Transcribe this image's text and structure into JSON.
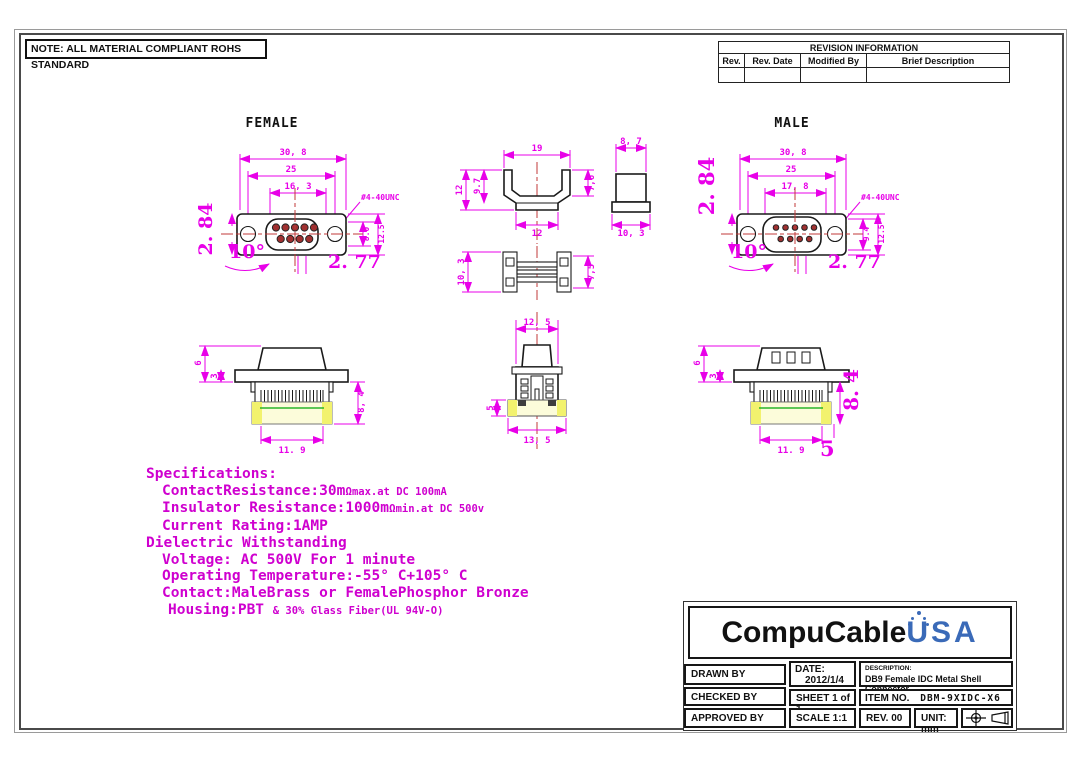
{
  "note": "NOTE: ALL MATERIAL COMPLIANT ROHS STANDARD",
  "colors": {
    "dimension_magenta": "#e800e8",
    "spec_magenta": "#cf00cf",
    "centerline_red": "#c03a3a",
    "highlight_yellow": "#f2f26e",
    "highlight_cyan": "#b7ecec",
    "logo_blue": "#3a6ab8"
  },
  "revision_table": {
    "title": "REVISION INFORMATION",
    "columns": [
      "Rev.",
      "Rev. Date",
      "Modified By",
      "Brief Description"
    ]
  },
  "views": {
    "female": {
      "label": "FEMALE",
      "front": {
        "width": "30, 8",
        "pitch": "25",
        "dsub": "16, 3",
        "screw": "#4-40UNC",
        "h1": "8.0",
        "h2": "12.5",
        "big_v": "2. 84",
        "angle": "10°",
        "big_h": "2. 77"
      },
      "side": {
        "d6": "6",
        "d3": "3",
        "d84": "8, 4",
        "d119": "11. 9"
      }
    },
    "male": {
      "label": "MALE",
      "front": {
        "width": "30, 8",
        "pitch": "25",
        "dsub": "17, 8",
        "screw": "#4-40UNC",
        "h1": "9.4",
        "h2": "12.5",
        "big_v": "2. 84",
        "angle": "10°",
        "big_h": "2. 77"
      },
      "side": {
        "d6": "6",
        "d3": "3",
        "d84": "8. 4",
        "d119": "11. 9",
        "d5": "5"
      }
    },
    "mid": {
      "top": {
        "d19": "19",
        "d12l": "12",
        "d97": "9.7",
        "d76": "7,6",
        "d12b": "12",
        "d87": "8, 7",
        "d103": "10, 3"
      },
      "side": {
        "d103": "10, 3",
        "d75": "7,5"
      },
      "rear": {
        "d125": "12, 5",
        "d5": "5",
        "d135": "13, 5"
      }
    }
  },
  "specs": {
    "title": "Specifications:",
    "contact_a": "ContactResistance:30m",
    "contact_omega": "Ω",
    "contact_b": "max.at DC 100mA",
    "insulator_a": "Insulator Resistance:1000m",
    "insulator_omega": "Ω",
    "insulator_b": "min.at DC 500v",
    "current": "Current Rating:1AMP",
    "dielectric": "Dielectric Withstanding",
    "voltage": "Voltage: AC 500V For 1 minute",
    "temperature": "Operating Temperature:-55° C+105° C",
    "contact_material": "Contact:MaleBrass or FemalePhosphor Bronze",
    "housing_a": "Housing:PBT",
    "housing_b": "& 30% Glass Fiber(UL 94V-O)"
  },
  "titleblock": {
    "logo_name": "CompuCable",
    "logo_suffix": "USA",
    "drawn_by": "DRAWN BY",
    "date_label": "DATE:",
    "date_value": "2012/1/4",
    "description_label": "DESCRIPTION:",
    "description_value": "DB9 Female IDC Metal Shell Connector",
    "checked_by": "CHECKED BY",
    "sheet": "SHEET 1 of 1",
    "item_label": "ITEM NO.",
    "item_value": "DBM-9XIDC-X6",
    "approved_by": "APPROVED BY",
    "scale": "SCALE 1:1",
    "rev": "REV. 00",
    "unit": "UNIT: mm"
  }
}
